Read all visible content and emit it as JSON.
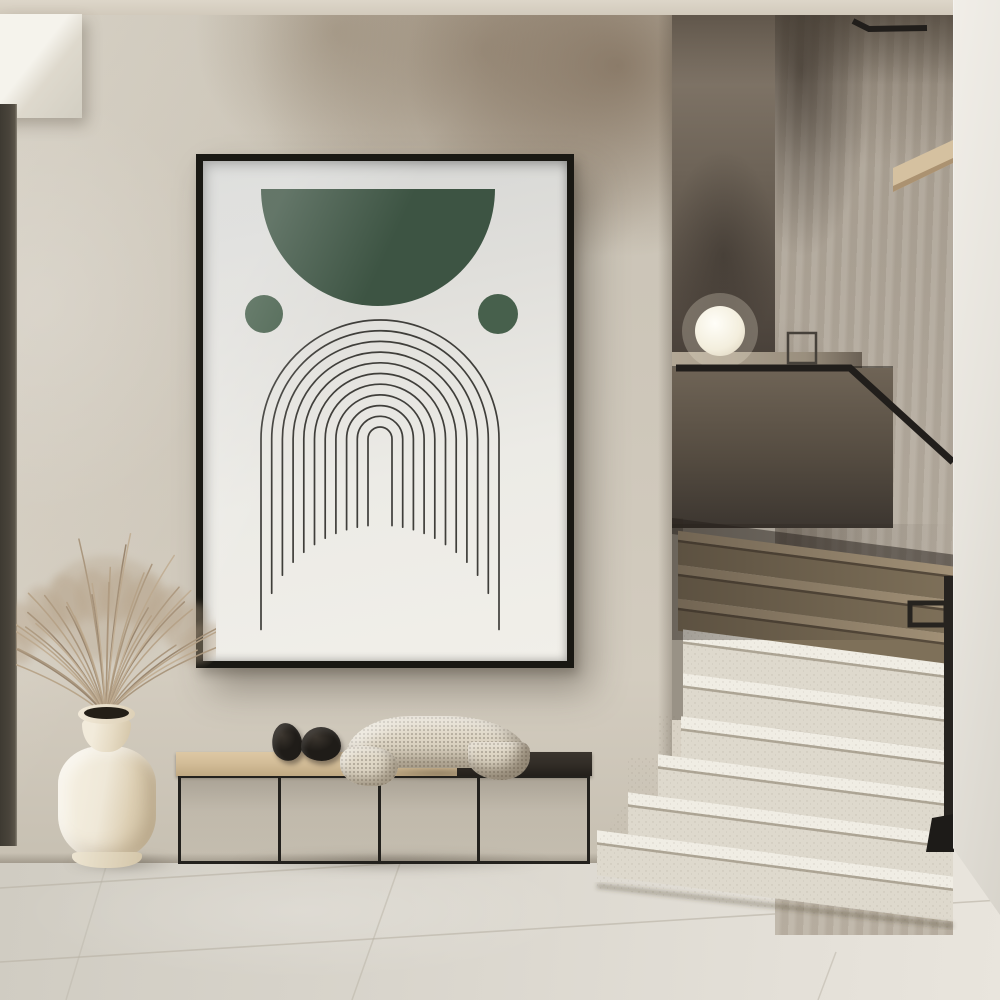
{
  "meta": {
    "title": "Minimalist hallway interior with framed arch line-art poster, ceramic vase with dried pampas grass, black metal bench and terrazzo staircase with sphere lamp",
    "style": "japandi wabi-sabi interior photograph",
    "text_content": "none"
  },
  "palette": {
    "ceiling": "#d8d1c4",
    "wall": "#cdc6b9",
    "wall_patina": "#8e7f6c",
    "soffit": "#f1eee7",
    "door_frame": "#49443b",
    "right_wall": "#ebe8e1",
    "floor": "#d9d5cc",
    "grout": "#b7b1a4",
    "stair_back_wall": "#6b6156",
    "stair_side_wall": "#b2a99c",
    "pony_wall": "#53493f",
    "ledge": "#a89d8d",
    "step_light_tread": "#f0ede4",
    "step_light_riser": "#ded9cd",
    "step_dark_tread": "#a29177",
    "step_dark_riser": "#7e7059",
    "rail": "#211e1b",
    "lamp": "#f7f4ea",
    "wood_niche": "#d5c1a0",
    "frame": "#191813",
    "paper_top": "#d5d6d4",
    "paper_bottom": "#f1efe9",
    "art_green": "#3d5443",
    "art_line": "#3f3e3a",
    "bench_frame": "#23211d",
    "cushion": "#d3bd98",
    "bench_dark_top": "#322d27",
    "blanket": "#e0d8c7",
    "pebble": "#1f1c18",
    "vase": "#efe8d8",
    "grass": "#ab9680"
  },
  "objects": {
    "poster": "Framed abstract print: dark green half-circle, two green dots, concentric arch lines with hanging tails",
    "bench": "Low black metal frame bench, beige cushion left section, dark wood right section",
    "blanket": "Cream waffle-knit throw draped over bench",
    "pebbles": "Two black stone decor objects on cushion",
    "vase": "Cream ceramic floor vase with dried pampas grass",
    "lamp": "Glowing white sphere lamp on stair landing ledge",
    "staircase": "Terrazzo stairs, dark shadowed upper flight, bright lower flight, black metal handrail and post",
    "floor": "Large-format light stone tiles"
  },
  "poster": {
    "frame_color": "#191813",
    "artwork": {
      "semicircle": {
        "cx": 175,
        "cy": 28,
        "r": 117,
        "fill": "#3d5443"
      },
      "dots": [
        {
          "cx": 61,
          "cy": 153,
          "r": 19,
          "fill": "#47604c"
        },
        {
          "cx": 295,
          "cy": 153,
          "r": 20,
          "fill": "#47604c"
        }
      ],
      "arches": {
        "cx": 177,
        "cy": 278,
        "count": 11,
        "r_outer": 119,
        "r_inner": 12,
        "stroke": "#3f3e3a",
        "stroke_width": 1.7,
        "dome_cy": 484,
        "dome_r": 120
      }
    }
  },
  "stairs": {
    "slope": 0.13,
    "x_origin": 672,
    "x_right": 953,
    "shadow_band": {
      "y": 518,
      "h": 16,
      "fill": "rgba(36,30,25,0.5)"
    },
    "upper": {
      "tread_h": 9,
      "tread": "#a29177",
      "riser": "#7e7059",
      "nose": "rgba(52,44,35,0.55)",
      "steps": [
        {
          "y": 530,
          "h": 34,
          "xl": 678
        },
        {
          "y": 564,
          "h": 34,
          "xl": 678
        },
        {
          "y": 598,
          "h": 32,
          "xl": 678
        }
      ]
    },
    "lower": {
      "tread_h": 12,
      "tread": "#f0ede4",
      "riser": "#ded9cd",
      "nose": "rgba(140,130,112,0.6)",
      "steps": [
        {
          "y": 628,
          "h": 44,
          "xl": 683
        },
        {
          "y": 672,
          "h": 43,
          "xl": 683
        },
        {
          "y": 715,
          "h": 41,
          "xl": 681
        },
        {
          "y": 756,
          "h": 42,
          "xl": 658
        },
        {
          "y": 798,
          "h": 42,
          "xl": 628
        },
        {
          "y": 840,
          "h": 45,
          "xl": 597
        }
      ]
    }
  },
  "lamp": {
    "cx": 720,
    "cy": 331,
    "r": 25
  },
  "grass": {
    "count": 34,
    "base_x": 90,
    "base_y": 196,
    "len_min": 95,
    "len_max": 168,
    "spread_deg": 118,
    "colors": [
      "#b6a287",
      "#a8937a",
      "#97836b",
      "#c1ae93"
    ],
    "fluff": {
      "count": 10,
      "color": "#b5a187",
      "opacity": 0.4
    }
  }
}
